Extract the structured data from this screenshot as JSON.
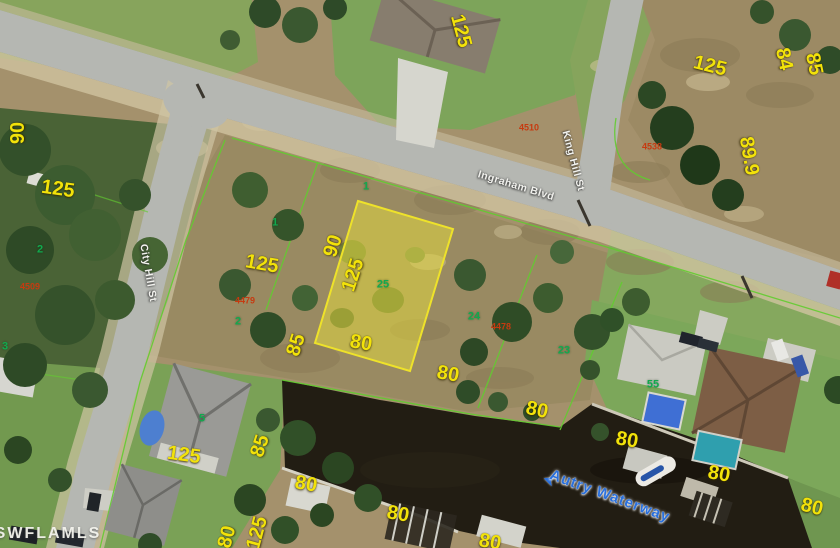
{
  "map": {
    "description": "Aerial parcel photo with highlighted lot",
    "colors": {
      "dim": "#f2e20a",
      "lot": "#12a94e",
      "pid": "#c63a10",
      "street": "#f2f2ee",
      "water-label": "#2a70dc",
      "parcel-fill": "#e8de3c",
      "parcel-stroke": "#eee22a",
      "cadastral-line": "#62cc30"
    },
    "labels": {
      "dimensions": [
        {
          "t": "90",
          "x": 18,
          "y": 133,
          "r": -90
        },
        {
          "t": "125",
          "x": 58,
          "y": 189,
          "r": 8
        },
        {
          "t": "125",
          "x": 461,
          "y": 31,
          "r": 75
        },
        {
          "t": "125",
          "x": 710,
          "y": 66,
          "r": 14
        },
        {
          "t": "84",
          "x": 784,
          "y": 59,
          "r": 78
        },
        {
          "t": "85",
          "x": 814,
          "y": 64,
          "r": 78
        },
        {
          "t": "89.9",
          "x": 749,
          "y": 156,
          "r": 80
        },
        {
          "t": "125",
          "x": 262,
          "y": 264,
          "r": 10
        },
        {
          "t": "90",
          "x": 333,
          "y": 246,
          "r": -72
        },
        {
          "t": "125",
          "x": 353,
          "y": 275,
          "r": -72
        },
        {
          "t": "80",
          "x": 361,
          "y": 343,
          "r": 10
        },
        {
          "t": "85",
          "x": 296,
          "y": 345,
          "r": -72
        },
        {
          "t": "80",
          "x": 448,
          "y": 374,
          "r": 10
        },
        {
          "t": "80",
          "x": 537,
          "y": 410,
          "r": 12
        },
        {
          "t": "80",
          "x": 306,
          "y": 484,
          "r": 10
        },
        {
          "t": "80",
          "x": 398,
          "y": 514,
          "r": 10
        },
        {
          "t": "80",
          "x": 490,
          "y": 542,
          "r": 10
        },
        {
          "t": "80",
          "x": 627,
          "y": 440,
          "r": 10
        },
        {
          "t": "80",
          "x": 719,
          "y": 474,
          "r": 10
        },
        {
          "t": "80",
          "x": 812,
          "y": 507,
          "r": 14
        },
        {
          "t": "85",
          "x": 260,
          "y": 446,
          "r": -72
        },
        {
          "t": "125",
          "x": 184,
          "y": 455,
          "r": 8
        },
        {
          "t": "80",
          "x": 227,
          "y": 537,
          "r": -75
        },
        {
          "t": "125",
          "x": 257,
          "y": 533,
          "r": -75
        }
      ],
      "lot_numbers": [
        {
          "t": "2",
          "x": 40,
          "y": 250
        },
        {
          "t": "2",
          "x": 238,
          "y": 322
        },
        {
          "t": "1",
          "x": 275,
          "y": 223
        },
        {
          "t": "1",
          "x": 366,
          "y": 187
        },
        {
          "t": "25",
          "x": 383,
          "y": 285
        },
        {
          "t": "24",
          "x": 474,
          "y": 317
        },
        {
          "t": "23",
          "x": 564,
          "y": 351
        },
        {
          "t": "55",
          "x": 653,
          "y": 385
        },
        {
          "t": "5",
          "x": 202,
          "y": 419
        },
        {
          "t": "3",
          "x": 5,
          "y": 347
        }
      ],
      "parcel_ids": [
        {
          "t": "4510",
          "x": 529,
          "y": 128
        },
        {
          "t": "4538",
          "x": 652,
          "y": 147
        },
        {
          "t": "4509",
          "x": 30,
          "y": 287
        },
        {
          "t": "4479",
          "x": 245,
          "y": 301
        },
        {
          "t": "4478",
          "x": 501,
          "y": 327
        }
      ],
      "streets": [
        {
          "t": "Ingraham Blvd",
          "x": 516,
          "y": 186,
          "r": 17
        },
        {
          "t": "King Hill St",
          "x": 573,
          "y": 161,
          "r": 75
        },
        {
          "t": "City Hill St",
          "x": 148,
          "y": 273,
          "r": 80
        }
      ],
      "waterway": [
        {
          "t": "Autry Waterway",
          "x": 610,
          "y": 496,
          "r": 20
        }
      ],
      "watermark": [
        {
          "t": "SWFLAMLS",
          "x": 48,
          "y": 534
        }
      ]
    },
    "waterway_arrow": "➤"
  }
}
